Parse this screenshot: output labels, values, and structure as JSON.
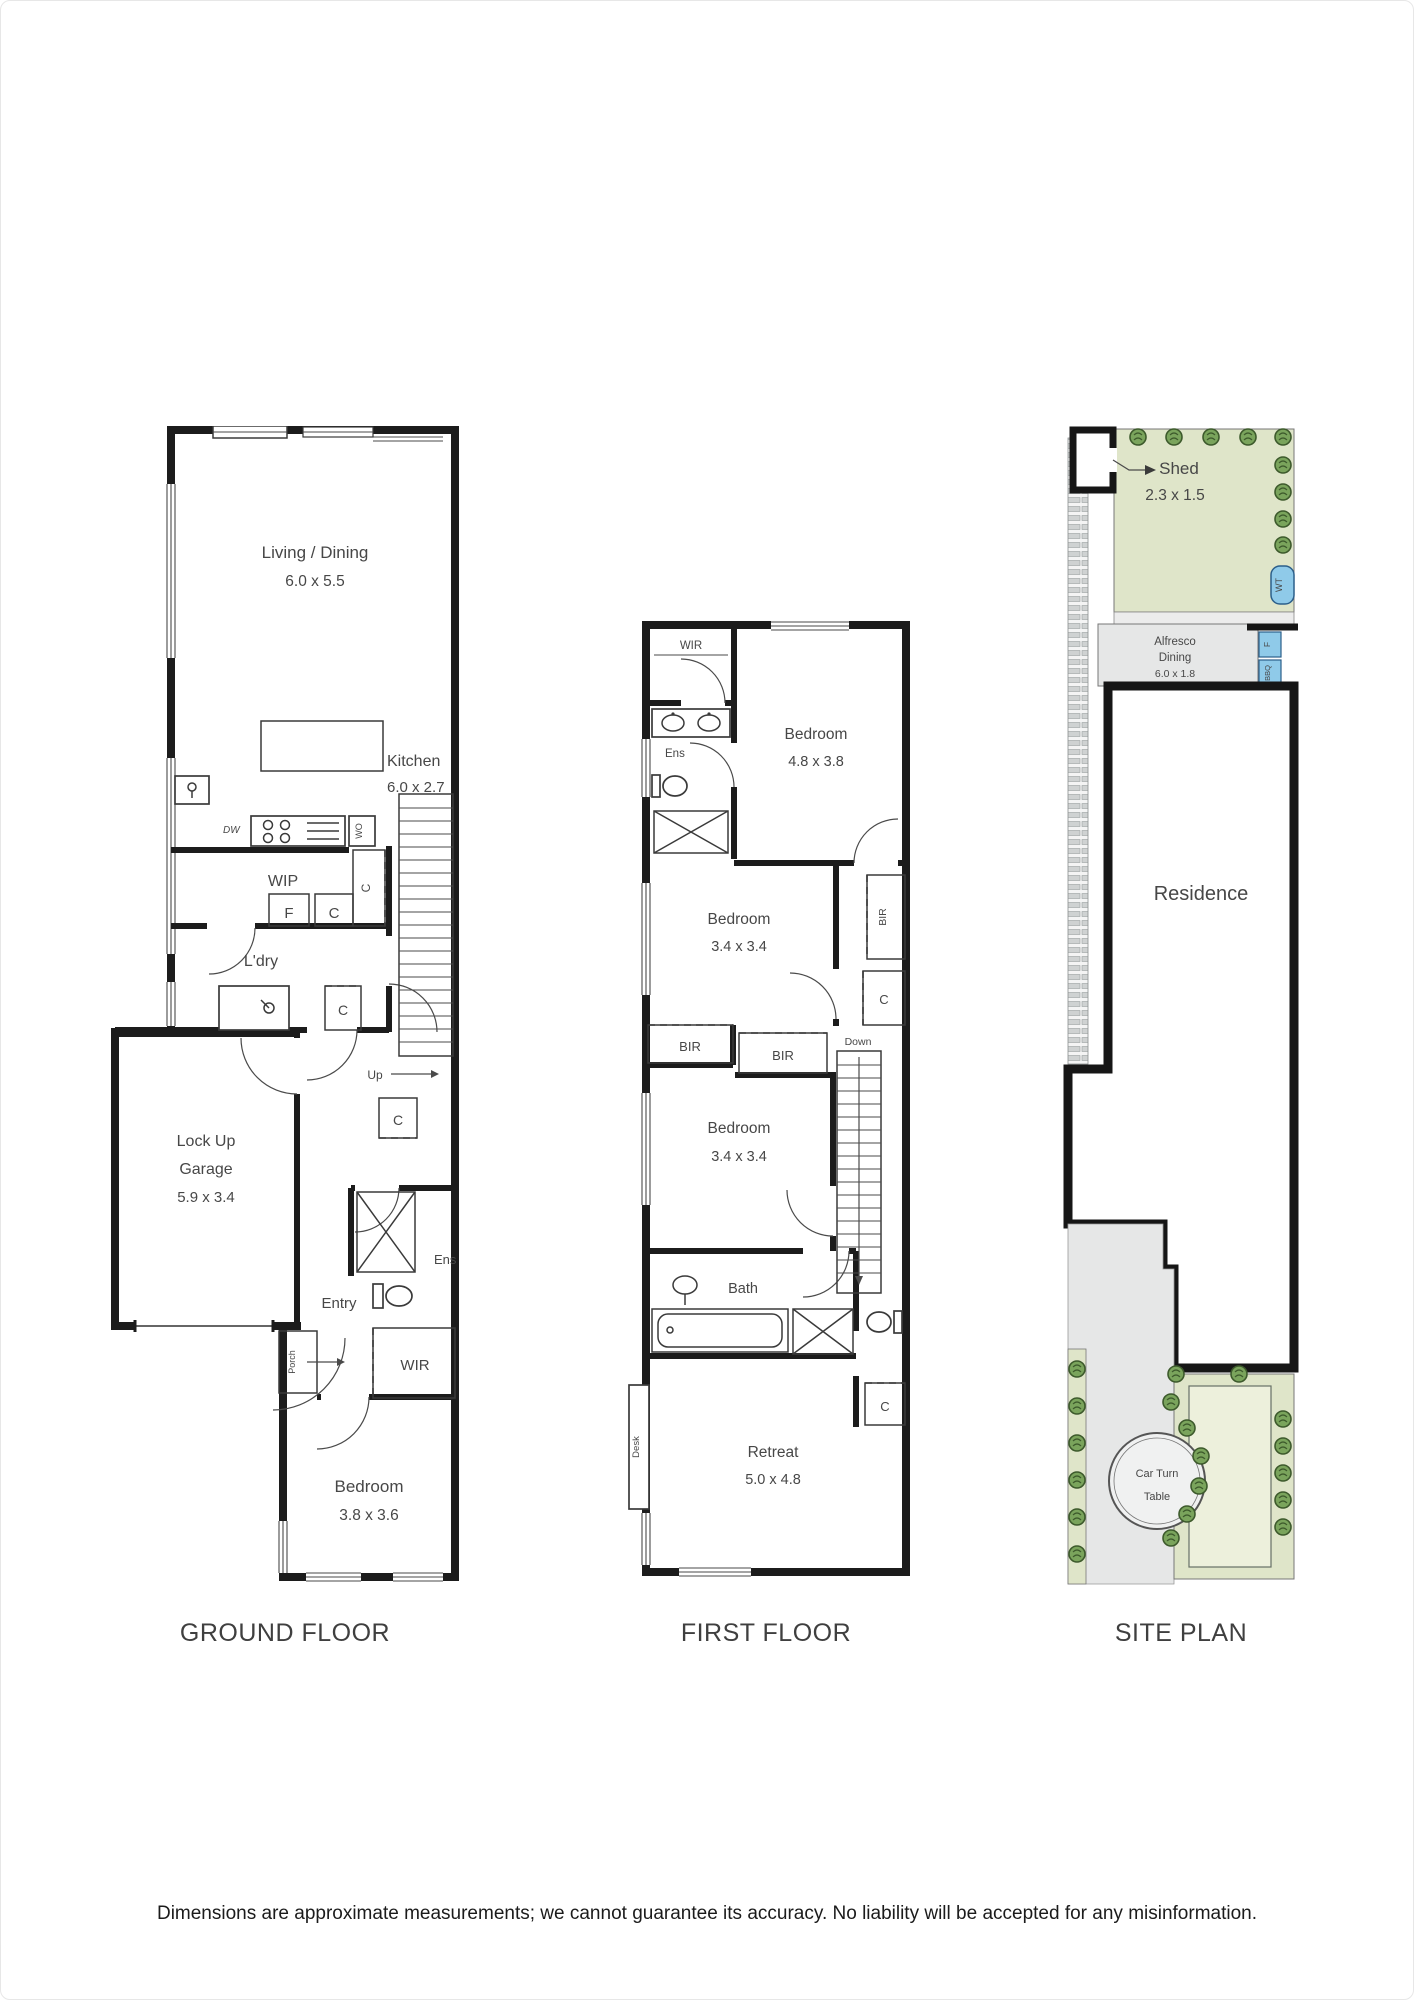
{
  "page": {
    "disclaimer": "Dimensions are approximate measurements; we cannot guarantee its accuracy. No liability will be accepted for any misinformation."
  },
  "captions": {
    "ground": "GROUND FLOOR",
    "first": "FIRST FLOOR",
    "site": "SITE PLAN"
  },
  "colors": {
    "wall": "#1c1c1c",
    "label": "#474747",
    "garden": "#dfe5c9",
    "garden_inner": "#edf0dc",
    "shrub": "#7aa45c",
    "shrub_line": "#3d5a2c",
    "paving": "#e6e7e7",
    "water_blue": "#8fcae9",
    "hatch_bar": "#cfd2d2"
  },
  "ground_floor": {
    "living": {
      "name": "Living / Dining",
      "dims": "6.0 x 5.5"
    },
    "kitchen": {
      "name": "Kitchen",
      "dims": "6.0 x 2.7"
    },
    "wip": "WIP",
    "ldry": "L'dry",
    "garage": {
      "line1": "Lock Up",
      "line2": "Garage",
      "dims": "5.9 x 3.4"
    },
    "entry": "Entry",
    "porch": "Porch",
    "up": "Up",
    "ens": "Ens",
    "wir": "WIR",
    "bedroom": {
      "name": "Bedroom",
      "dims": "3.8 x 3.6"
    },
    "fridge": "F",
    "cupboard": "C",
    "dishwasher": "DW",
    "wall_oven": "WO"
  },
  "first_floor": {
    "wir": "WIR",
    "ens": "Ens",
    "bedroom1": {
      "name": "Bedroom",
      "dims": "4.8 x 3.8"
    },
    "bedroom2": {
      "name": "Bedroom",
      "dims": "3.4 x 3.4"
    },
    "bedroom3": {
      "name": "Bedroom",
      "dims": "3.4 x 3.4"
    },
    "bir": "BIR",
    "cupboard": "C",
    "down": "Down",
    "bath": "Bath",
    "retreat": {
      "name": "Retreat",
      "dims": "5.0 x 4.8"
    },
    "desk": "Desk"
  },
  "site_plan": {
    "shed": {
      "name": "Shed",
      "dims": "2.3 x 1.5"
    },
    "alfresco": {
      "line1": "Alfresco",
      "line2": "Dining",
      "line3": "6.0 x 1.8"
    },
    "residence": "Residence",
    "turntable": {
      "line1": "Car Turn",
      "line2": "Table"
    },
    "water_tank": "WT",
    "fridge": "F",
    "bbq": "BBQ"
  }
}
